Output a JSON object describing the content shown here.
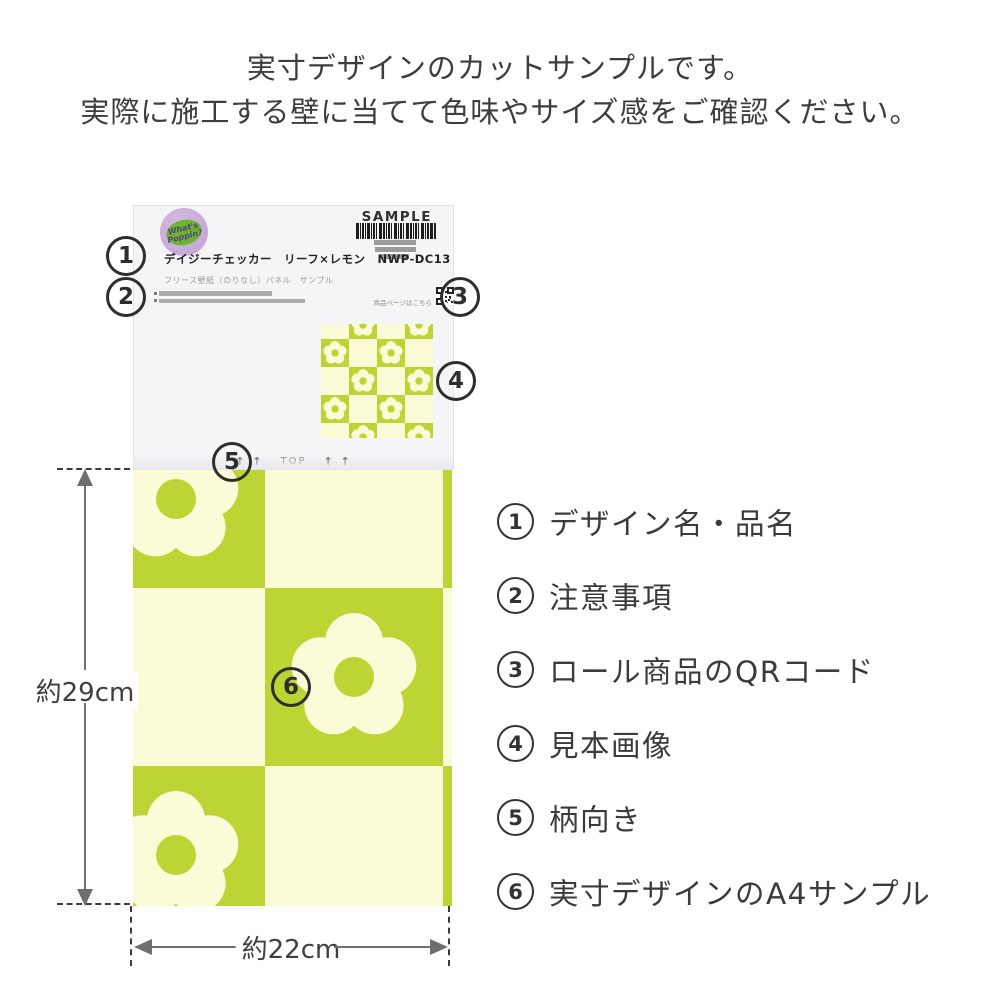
{
  "title": {
    "line1": "実寸デザインのカットサンプルです。",
    "line2": "実際に施工する壁に当てて色味やサイズ感をご確認ください。"
  },
  "label_card": {
    "sample_text": "SAMPLE",
    "badge": {
      "line1": "What's",
      "line2": "Poppin?"
    },
    "product_name": "デイジーチェッカー　リーフ×レモン　NWP-DC13",
    "product_sub": "フリース壁紙（のりなし）パネル　サンプル",
    "qr_caption": "商品ページはこちら",
    "orientation": {
      "arrows_left": "↑ ↑",
      "label": "TOP",
      "arrows_right": "↑ ↑"
    }
  },
  "callouts": [
    "1",
    "2",
    "3",
    "4",
    "5",
    "6"
  ],
  "legend": {
    "items": [
      {
        "num": "1",
        "label": "デザイン名・品名"
      },
      {
        "num": "2",
        "label": "注意事項"
      },
      {
        "num": "3",
        "label": "ロール商品のQRコード"
      },
      {
        "num": "4",
        "label": "見本画像"
      },
      {
        "num": "5",
        "label": "柄向き"
      },
      {
        "num": "6",
        "label": "実寸デザインのA4サンプル"
      }
    ]
  },
  "dimensions": {
    "height_label": "約29cm",
    "width_label": "約22cm"
  },
  "colors": {
    "pattern_green": "#bcd434",
    "pattern_cream": "#fbfbd7",
    "badge_purple": "#c2a2d3",
    "badge_blob_green": "#6cb52f",
    "callout_dark": "#2e2e2e"
  }
}
